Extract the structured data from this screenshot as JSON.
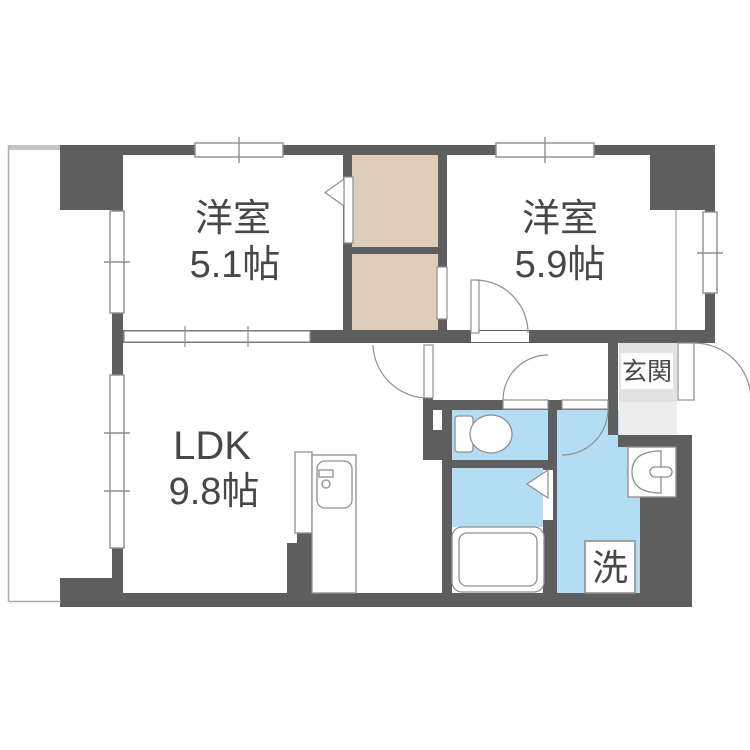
{
  "title": "apartment-floor-plan",
  "colors": {
    "wall": "#5e5e5e",
    "closet": "#decdbb",
    "wet_area": "#b4ddf3",
    "entrance": "#e2e2e2",
    "entrance_step": "#ededed",
    "outline": "#8f8f8f",
    "balcony_line": "#ababab",
    "balcony_band": "#c3c3c3",
    "text": "#474747",
    "white": "#ffffff"
  },
  "rooms": {
    "bedroom1": {
      "name": "洋室",
      "size": "5.1帖"
    },
    "bedroom2": {
      "name": "洋室",
      "size": "5.9帖"
    },
    "ldk": {
      "name": "LDK",
      "size": "9.8帖"
    },
    "entrance": {
      "label": "玄関"
    },
    "laundry": {
      "label": "洗"
    }
  }
}
